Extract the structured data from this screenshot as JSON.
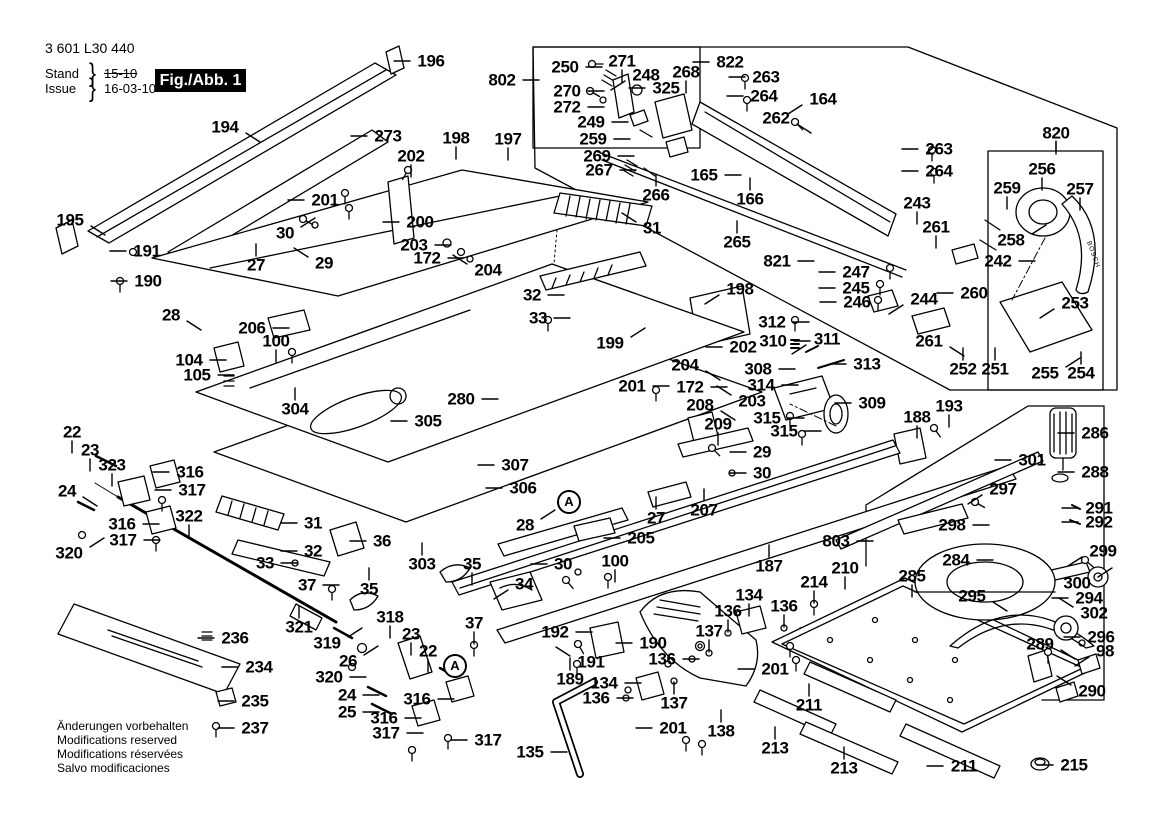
{
  "header": {
    "part_number": "3 601 L30 440",
    "stand_label": "Stand",
    "issue_label": "Issue",
    "stand_value": "15-10",
    "issue_value": "16-03-10",
    "figure_label": "Fig./Abb. 1",
    "brace": "}"
  },
  "footer": {
    "notes": [
      "Änderungen vorbehalten",
      "Modifications reserved",
      "Modifications réservées",
      "Salvo modificaciones"
    ]
  },
  "brand": {
    "text": "BOSCH"
  },
  "colors": {
    "ink": "#000000",
    "paper": "#ffffff"
  },
  "detail_markers": [
    {
      "label": "A",
      "x": 569,
      "y": 502
    },
    {
      "label": "A",
      "x": 455,
      "y": 666
    }
  ],
  "labels": [
    [
      "196",
      431,
      61,
      "l"
    ],
    [
      "194",
      225,
      127,
      "dr"
    ],
    [
      "273",
      388,
      136,
      "l"
    ],
    [
      "198",
      456,
      138,
      "d"
    ],
    [
      "197",
      508,
      139,
      "d"
    ],
    [
      "202",
      411,
      156,
      "d"
    ],
    [
      "195",
      70,
      220,
      "dr"
    ],
    [
      "191",
      147,
      251,
      "l"
    ],
    [
      "190",
      148,
      281,
      "l"
    ],
    [
      "201",
      325,
      200,
      "l"
    ],
    [
      "30",
      285,
      233,
      "ur"
    ],
    [
      "29",
      324,
      263,
      "ul"
    ],
    [
      "27",
      256,
      265,
      "u"
    ],
    [
      "28",
      171,
      315,
      "dr"
    ],
    [
      "200",
      420,
      222,
      "l"
    ],
    [
      "203",
      414,
      245,
      "r"
    ],
    [
      "172",
      427,
      258,
      "r"
    ],
    [
      "204",
      488,
      270,
      "ul"
    ],
    [
      "802",
      502,
      80,
      "r"
    ],
    [
      "250",
      565,
      67,
      "r"
    ],
    [
      "271",
      622,
      61,
      "d"
    ],
    [
      "248",
      646,
      75,
      "dl"
    ],
    [
      "268",
      686,
      72,
      "d"
    ],
    [
      "325",
      666,
      88,
      "l"
    ],
    [
      "270",
      567,
      91,
      "r"
    ],
    [
      "272",
      567,
      107,
      "r"
    ],
    [
      "249",
      591,
      122,
      "r"
    ],
    [
      "259",
      593,
      139,
      "r"
    ],
    [
      "269",
      597,
      156,
      "r"
    ],
    [
      "267",
      599,
      170,
      "r"
    ],
    [
      "266",
      656,
      195,
      "u"
    ],
    [
      "31",
      652,
      228,
      "ul"
    ],
    [
      "165",
      704,
      175,
      "r"
    ],
    [
      "166",
      750,
      199,
      "u"
    ],
    [
      "822",
      730,
      62,
      "l"
    ],
    [
      "263",
      766,
      77,
      "l"
    ],
    [
      "264",
      764,
      96,
      "l"
    ],
    [
      "164",
      823,
      99,
      "dl"
    ],
    [
      "262",
      776,
      118,
      "dr"
    ],
    [
      "263",
      939,
      149,
      "l"
    ],
    [
      "264",
      939,
      171,
      "l"
    ],
    [
      "820",
      1056,
      133,
      "d"
    ],
    [
      "256",
      1042,
      169,
      "d"
    ],
    [
      "259",
      1007,
      188,
      "d"
    ],
    [
      "257",
      1080,
      189,
      "d"
    ],
    [
      "258",
      1011,
      240,
      "ur"
    ],
    [
      "242",
      998,
      261,
      "r"
    ],
    [
      "243",
      917,
      203,
      "d"
    ],
    [
      "261",
      936,
      227,
      "d"
    ],
    [
      "265",
      737,
      242,
      "u"
    ],
    [
      "821",
      777,
      261,
      "r"
    ],
    [
      "247",
      856,
      272,
      "l"
    ],
    [
      "245",
      856,
      288,
      "l"
    ],
    [
      "246",
      857,
      302,
      "l"
    ],
    [
      "244",
      924,
      299,
      "dl"
    ],
    [
      "260",
      974,
      293,
      "l"
    ],
    [
      "261",
      929,
      341,
      "dr"
    ],
    [
      "252",
      963,
      369,
      "u"
    ],
    [
      "251",
      995,
      369,
      "u"
    ],
    [
      "253",
      1075,
      303,
      "dl"
    ],
    [
      "255",
      1045,
      373,
      "ur"
    ],
    [
      "254",
      1081,
      373,
      "u"
    ],
    [
      "312",
      772,
      322,
      "r"
    ],
    [
      "310",
      773,
      341,
      "r"
    ],
    [
      "311",
      827,
      339,
      "dl"
    ],
    [
      "313",
      867,
      364,
      "l"
    ],
    [
      "308",
      758,
      369,
      "r"
    ],
    [
      "314",
      761,
      385,
      "r"
    ],
    [
      "315",
      767,
      418,
      "r"
    ],
    [
      "315",
      784,
      431,
      "r"
    ],
    [
      "309",
      872,
      403,
      "l"
    ],
    [
      "202",
      743,
      347,
      "l"
    ],
    [
      "203",
      752,
      401,
      "ul"
    ],
    [
      "208",
      700,
      405,
      "dr"
    ],
    [
      "209",
      718,
      424,
      "d"
    ],
    [
      "204",
      685,
      365,
      "dr"
    ],
    [
      "172",
      690,
      387,
      "r"
    ],
    [
      "201",
      632,
      386,
      "r"
    ],
    [
      "198",
      740,
      289,
      "dl"
    ],
    [
      "199",
      610,
      343,
      "ur"
    ],
    [
      "32",
      532,
      295,
      "r"
    ],
    [
      "33",
      538,
      318,
      "r"
    ],
    [
      "280",
      461,
      399,
      "r"
    ],
    [
      "305",
      428,
      421,
      "l"
    ],
    [
      "307",
      515,
      465,
      "l"
    ],
    [
      "306",
      523,
      488,
      "l"
    ],
    [
      "304",
      295,
      409,
      "u"
    ],
    [
      "206",
      252,
      328,
      "r"
    ],
    [
      "100",
      276,
      341,
      "d"
    ],
    [
      "104",
      189,
      360,
      "r"
    ],
    [
      "105",
      197,
      375,
      "r"
    ],
    [
      "29",
      762,
      452,
      "l"
    ],
    [
      "30",
      762,
      473,
      "l"
    ],
    [
      "27",
      656,
      518,
      "u"
    ],
    [
      "28",
      525,
      525,
      "ur"
    ],
    [
      "205",
      641,
      538,
      "l"
    ],
    [
      "207",
      704,
      510,
      "u"
    ],
    [
      "188",
      917,
      417,
      "d"
    ],
    [
      "193",
      949,
      406,
      "d"
    ],
    [
      "301",
      1032,
      460,
      "l"
    ],
    [
      "286",
      1095,
      433,
      "l"
    ],
    [
      "288",
      1095,
      472,
      "l"
    ],
    [
      "297",
      1003,
      489,
      "dl"
    ],
    [
      "298",
      952,
      525,
      "r"
    ],
    [
      "291",
      1099,
      508,
      "l"
    ],
    [
      "292",
      1099,
      522,
      "l"
    ],
    [
      "284",
      956,
      560,
      "r"
    ],
    [
      "295",
      972,
      596,
      "dr"
    ],
    [
      "299",
      1103,
      551,
      "dl"
    ],
    [
      "300",
      1077,
      583,
      "ur"
    ],
    [
      "294",
      1089,
      598,
      "l"
    ],
    [
      "302",
      1094,
      613,
      "ul"
    ],
    [
      "289",
      1040,
      644,
      "dr"
    ],
    [
      "296",
      1101,
      637,
      "l"
    ],
    [
      "98",
      1105,
      651,
      "dl"
    ],
    [
      "290",
      1092,
      691,
      "ul"
    ],
    [
      "215",
      1074,
      765,
      "l"
    ],
    [
      "211",
      809,
      705,
      "u"
    ],
    [
      "211",
      964,
      766,
      "l"
    ],
    [
      "213",
      775,
      748,
      "u"
    ],
    [
      "213",
      844,
      768,
      "u"
    ],
    [
      "803",
      836,
      541,
      "r"
    ],
    [
      "210",
      845,
      568,
      "d"
    ],
    [
      "285",
      912,
      576,
      "d"
    ],
    [
      "214",
      814,
      582,
      "d"
    ],
    [
      "136",
      784,
      606,
      "d"
    ],
    [
      "187",
      769,
      566,
      "u"
    ],
    [
      "134",
      749,
      595,
      "d"
    ],
    [
      "136",
      728,
      611,
      "d"
    ],
    [
      "137",
      709,
      631,
      "d"
    ],
    [
      "136",
      662,
      659,
      "r"
    ],
    [
      "134",
      604,
      683,
      "r"
    ],
    [
      "136",
      596,
      698,
      "r"
    ],
    [
      "137",
      674,
      703,
      "u"
    ],
    [
      "201",
      673,
      728,
      "l"
    ],
    [
      "138",
      721,
      731,
      "u"
    ],
    [
      "192",
      555,
      632,
      "r"
    ],
    [
      "190",
      653,
      643,
      "l"
    ],
    [
      "191",
      591,
      662,
      "ul"
    ],
    [
      "189",
      570,
      679,
      "u"
    ],
    [
      "135",
      530,
      752,
      "r"
    ],
    [
      "201",
      775,
      669,
      "l"
    ],
    [
      "22",
      72,
      432,
      "d"
    ],
    [
      "23",
      90,
      450,
      "d"
    ],
    [
      "323",
      112,
      465,
      "d"
    ],
    [
      "24",
      67,
      491,
      "dr"
    ],
    [
      "316",
      190,
      472,
      "l"
    ],
    [
      "317",
      192,
      490,
      "l"
    ],
    [
      "316",
      122,
      524,
      "r"
    ],
    [
      "317",
      123,
      540,
      "r"
    ],
    [
      "320",
      69,
      553,
      "ur"
    ],
    [
      "322",
      189,
      516,
      "d"
    ],
    [
      "31",
      313,
      523,
      "l"
    ],
    [
      "32",
      313,
      551,
      "l"
    ],
    [
      "33",
      265,
      563,
      "r"
    ],
    [
      "36",
      382,
      541,
      "l"
    ],
    [
      "303",
      422,
      564,
      "u"
    ],
    [
      "35",
      369,
      589,
      "u"
    ],
    [
      "35",
      472,
      564,
      "d"
    ],
    [
      "34",
      524,
      584,
      "dl"
    ],
    [
      "37",
      307,
      585,
      "r"
    ],
    [
      "37",
      474,
      623,
      "d"
    ],
    [
      "318",
      390,
      617,
      "d"
    ],
    [
      "321",
      299,
      627,
      "u"
    ],
    [
      "319",
      327,
      643,
      "ur"
    ],
    [
      "26",
      348,
      661,
      "ur"
    ],
    [
      "320",
      329,
      677,
      "r"
    ],
    [
      "24",
      347,
      695,
      "r"
    ],
    [
      "25",
      347,
      712,
      "r"
    ],
    [
      "23",
      411,
      634,
      "d"
    ],
    [
      "22",
      428,
      651,
      "d"
    ],
    [
      "316",
      417,
      699,
      "r"
    ],
    [
      "316",
      384,
      718,
      "r"
    ],
    [
      "317",
      386,
      733,
      "r"
    ],
    [
      "317",
      488,
      740,
      "l"
    ],
    [
      "236",
      235,
      638,
      "l"
    ],
    [
      "234",
      259,
      667,
      "l"
    ],
    [
      "235",
      255,
      701,
      "l"
    ],
    [
      "237",
      255,
      728,
      "l"
    ],
    [
      "30",
      563,
      564,
      "l"
    ],
    [
      "100",
      615,
      561,
      "d"
    ]
  ]
}
